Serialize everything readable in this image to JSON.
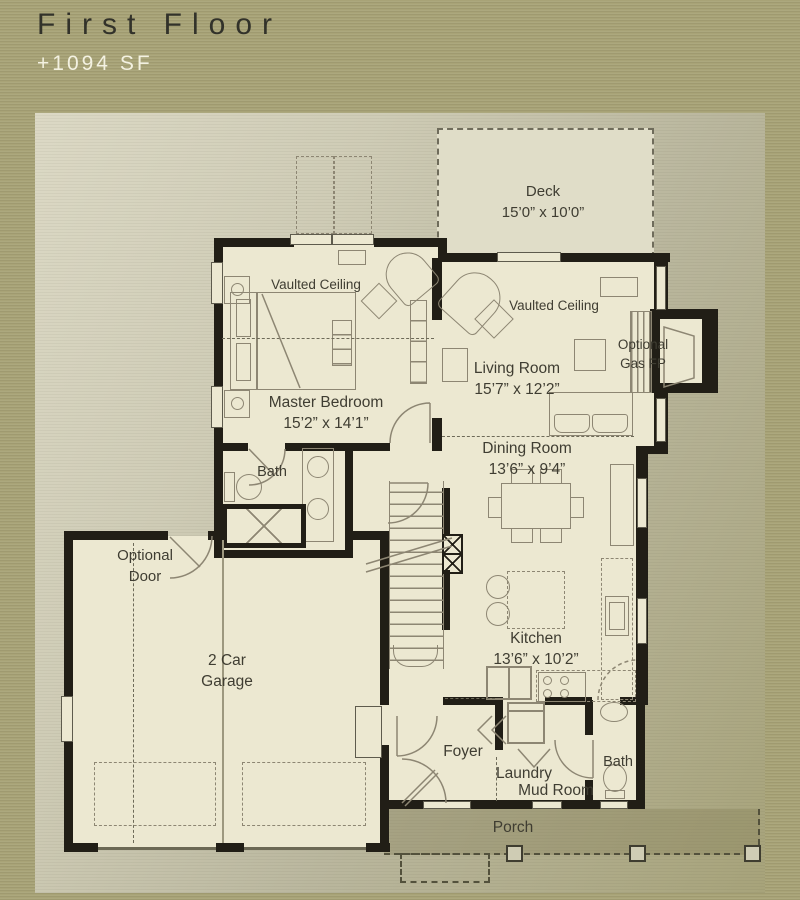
{
  "header": {
    "title": "First Floor",
    "area": "+1094 SF"
  },
  "rooms": {
    "deck": {
      "name": "Deck",
      "dims": "15’0” x 10’0”"
    },
    "master_bedroom": {
      "name": "Master Bedroom",
      "dims": "15’2” x 14’1”",
      "ceiling": "Vaulted Ceiling"
    },
    "living_room": {
      "name": "Living Room",
      "dims": "15’7” x 12’2”",
      "ceiling": "Vaulted Ceiling"
    },
    "fireplace": {
      "line1": "Optional",
      "line2": "Gas FP"
    },
    "dining_room": {
      "name": "Dining Room",
      "dims": "13’6” x 9’4”"
    },
    "master_bath": {
      "name": "Bath"
    },
    "garage": {
      "line1": "2 Car",
      "line2": "Garage",
      "optional_door_line1": "Optional",
      "optional_door_line2": "Door"
    },
    "kitchen": {
      "name": "Kitchen",
      "dims": "13’6” x 10’2”"
    },
    "foyer": {
      "name": "Foyer"
    },
    "laundry": {
      "line1": "Laundry",
      "line2": "Mud Room"
    },
    "bath2": {
      "name": "Bath"
    },
    "porch": {
      "name": "Porch"
    }
  },
  "colors": {
    "background_olive": "#a8a377",
    "panel_light": "#d8d5c1",
    "floor_cream": "#ece8d1",
    "wall_black": "#211e16",
    "deck_cream": "#e0ddc8",
    "line_brown": "#8d8673",
    "title_text": "#32322a",
    "area_text": "#f3f1e1",
    "label_text": "#3f3d32"
  }
}
